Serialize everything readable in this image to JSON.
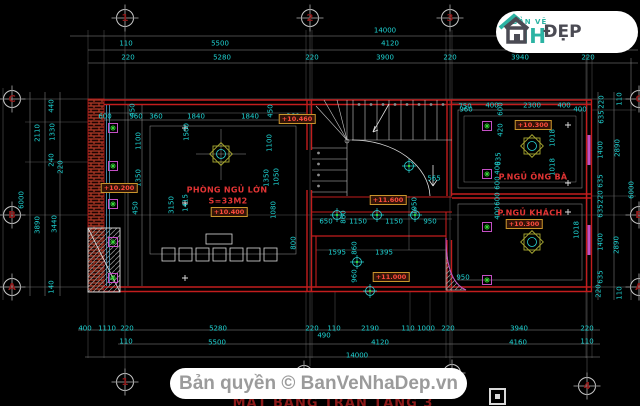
{
  "logo": {
    "tagline": "BẢN VẼ",
    "brand_left": "NH",
    "brand_right": "ĐẸP"
  },
  "footer": {
    "copyright": "Bản quyền © BanVeNhaDep.vn",
    "title": "MẶT BẰNG TRẦN TẦNG 3"
  },
  "colors": {
    "background": "#000000",
    "dimension_text": "#1ed3d3",
    "wall": "#c21d1d",
    "room_label": "#e23434",
    "brand_teal": "#2bb3a3",
    "brand_dark": "#4b4b54"
  },
  "grid": {
    "bubbles": [
      {
        "label": "1",
        "x": 125,
        "y": 18
      },
      {
        "label": "2",
        "x": 310,
        "y": 18
      },
      {
        "label": "3",
        "x": 450,
        "y": 18
      },
      {
        "label": "C",
        "x": 12,
        "y": 99
      },
      {
        "label": "B",
        "x": 12,
        "y": 215
      },
      {
        "label": "A",
        "x": 12,
        "y": 287
      },
      {
        "label": "1",
        "x": 125,
        "y": 382
      },
      {
        "label": "2",
        "x": 304,
        "y": 374
      },
      {
        "label": "3",
        "x": 452,
        "y": 373
      },
      {
        "label": "4",
        "x": 587,
        "y": 386
      },
      {
        "label": "C",
        "x": 639,
        "y": 99
      },
      {
        "label": "B",
        "x": 639,
        "y": 215
      },
      {
        "label": "A",
        "x": 639,
        "y": 287
      }
    ]
  },
  "labels": [
    {
      "t": "14000",
      "x": 385,
      "y": 31
    },
    {
      "t": "110",
      "x": 126,
      "y": 44
    },
    {
      "t": "5500",
      "x": 220,
      "y": 44
    },
    {
      "t": "4120",
      "x": 390,
      "y": 44
    },
    {
      "t": "220",
      "x": 128,
      "y": 58
    },
    {
      "t": "5280",
      "x": 222,
      "y": 58
    },
    {
      "t": "220",
      "x": 312,
      "y": 58
    },
    {
      "t": "3900",
      "x": 385,
      "y": 58
    },
    {
      "t": "220",
      "x": 450,
      "y": 58
    },
    {
      "t": "3940",
      "x": 520,
      "y": 58
    },
    {
      "t": "220",
      "x": 588,
      "y": 58
    },
    {
      "t": "400",
      "x": 85,
      "y": 329
    },
    {
      "t": "1110",
      "x": 107,
      "y": 329
    },
    {
      "t": "220",
      "x": 127,
      "y": 329
    },
    {
      "t": "5280",
      "x": 218,
      "y": 329
    },
    {
      "t": "220",
      "x": 312,
      "y": 329
    },
    {
      "t": "110",
      "x": 334,
      "y": 329
    },
    {
      "t": "2190",
      "x": 370,
      "y": 329
    },
    {
      "t": "110",
      "x": 408,
      "y": 329
    },
    {
      "t": "1000",
      "x": 426,
      "y": 329
    },
    {
      "t": "220",
      "x": 448,
      "y": 329
    },
    {
      "t": "3940",
      "x": 519,
      "y": 329
    },
    {
      "t": "220",
      "x": 587,
      "y": 329
    },
    {
      "t": "490",
      "x": 324,
      "y": 336
    },
    {
      "t": "110",
      "x": 126,
      "y": 342
    },
    {
      "t": "5500",
      "x": 217,
      "y": 343
    },
    {
      "t": "4120",
      "x": 380,
      "y": 343
    },
    {
      "t": "4160",
      "x": 518,
      "y": 343
    },
    {
      "t": "110",
      "x": 587,
      "y": 342
    },
    {
      "t": "14000",
      "x": 357,
      "y": 356
    },
    {
      "t": "6000",
      "x": 22,
      "y": 200,
      "r": 1
    },
    {
      "t": "2110",
      "x": 38,
      "y": 133,
      "r": 1
    },
    {
      "t": "3890",
      "x": 38,
      "y": 225,
      "r": 1
    },
    {
      "t": "440",
      "x": 52,
      "y": 106,
      "r": 1
    },
    {
      "t": "1330",
      "x": 53,
      "y": 132,
      "r": 1
    },
    {
      "t": "240",
      "x": 52,
      "y": 160,
      "r": 1
    },
    {
      "t": "220",
      "x": 61,
      "y": 167,
      "r": 1
    },
    {
      "t": "3440",
      "x": 55,
      "y": 224,
      "r": 1
    },
    {
      "t": "140",
      "x": 52,
      "y": 287,
      "r": 1
    },
    {
      "t": "220",
      "x": 602,
      "y": 102,
      "r": 1
    },
    {
      "t": "635",
      "x": 602,
      "y": 117,
      "r": 1
    },
    {
      "t": "1400",
      "x": 601,
      "y": 150,
      "r": 1
    },
    {
      "t": "635",
      "x": 601,
      "y": 181,
      "r": 1
    },
    {
      "t": "220",
      "x": 601,
      "y": 197,
      "r": 1
    },
    {
      "t": "635",
      "x": 601,
      "y": 211,
      "r": 1
    },
    {
      "t": "1400",
      "x": 601,
      "y": 242,
      "r": 1
    },
    {
      "t": "635",
      "x": 601,
      "y": 277,
      "r": 1
    },
    {
      "t": "220",
      "x": 599,
      "y": 291,
      "r": 1
    },
    {
      "t": "110",
      "x": 620,
      "y": 99,
      "r": 1
    },
    {
      "t": "2890",
      "x": 618,
      "y": 148,
      "r": 1
    },
    {
      "t": "2890",
      "x": 617,
      "y": 245,
      "r": 1
    },
    {
      "t": "110",
      "x": 620,
      "y": 293,
      "r": 1
    },
    {
      "t": "6000",
      "x": 632,
      "y": 190,
      "r": 1
    },
    {
      "t": "600",
      "x": 105,
      "y": 117
    },
    {
      "t": "960",
      "x": 136,
      "y": 117
    },
    {
      "t": "360",
      "x": 156,
      "y": 117
    },
    {
      "t": "1840",
      "x": 196,
      "y": 117
    },
    {
      "t": "1840",
      "x": 250,
      "y": 117
    },
    {
      "t": "360",
      "x": 293,
      "y": 117
    },
    {
      "t": "450",
      "x": 133,
      "y": 110,
      "r": 1
    },
    {
      "t": "450",
      "x": 271,
      "y": 111,
      "r": 1
    },
    {
      "t": "1100",
      "x": 139,
      "y": 141,
      "r": 1
    },
    {
      "t": "1500",
      "x": 187,
      "y": 132,
      "r": 1
    },
    {
      "t": "1100",
      "x": 270,
      "y": 143,
      "r": 1
    },
    {
      "t": "1350",
      "x": 139,
      "y": 178,
      "r": 1
    },
    {
      "t": "1350",
      "x": 267,
      "y": 178,
      "r": 1
    },
    {
      "t": "1050",
      "x": 277,
      "y": 177,
      "r": 1
    },
    {
      "t": "1080",
      "x": 274,
      "y": 210,
      "r": 1
    },
    {
      "t": "450",
      "x": 136,
      "y": 208,
      "r": 1
    },
    {
      "t": "1415",
      "x": 186,
      "y": 203,
      "r": 1
    },
    {
      "t": "3150",
      "x": 172,
      "y": 205,
      "r": 1
    },
    {
      "t": "960",
      "x": 466,
      "y": 110
    },
    {
      "t": "565",
      "x": 434,
      "y": 179
    },
    {
      "t": "650",
      "x": 326,
      "y": 222
    },
    {
      "t": "1150",
      "x": 358,
      "y": 222
    },
    {
      "t": "1150",
      "x": 394,
      "y": 222
    },
    {
      "t": "950",
      "x": 430,
      "y": 222
    },
    {
      "t": "1595",
      "x": 337,
      "y": 253
    },
    {
      "t": "1395",
      "x": 384,
      "y": 253
    },
    {
      "t": "950",
      "x": 463,
      "y": 278
    },
    {
      "t": "1950",
      "x": 415,
      "y": 206,
      "r": 1
    },
    {
      "t": "860",
      "x": 344,
      "y": 217,
      "r": 1
    },
    {
      "t": "860",
      "x": 355,
      "y": 248,
      "r": 1
    },
    {
      "t": "960",
      "x": 355,
      "y": 276,
      "r": 1
    },
    {
      "t": "800",
      "x": 294,
      "y": 243,
      "r": 1
    },
    {
      "t": "750",
      "x": 465,
      "y": 107
    },
    {
      "t": "400",
      "x": 492,
      "y": 106
    },
    {
      "t": "2300",
      "x": 532,
      "y": 106
    },
    {
      "t": "400",
      "x": 564,
      "y": 106
    },
    {
      "t": "400",
      "x": 580,
      "y": 110
    },
    {
      "t": "600",
      "x": 501,
      "y": 109,
      "r": 1
    },
    {
      "t": "420",
      "x": 501,
      "y": 130,
      "r": 1
    },
    {
      "t": "635",
      "x": 499,
      "y": 159,
      "r": 1
    },
    {
      "t": "1018",
      "x": 553,
      "y": 138,
      "r": 1
    },
    {
      "t": "1018",
      "x": 553,
      "y": 167,
      "r": 1
    },
    {
      "t": "400",
      "x": 498,
      "y": 168,
      "r": 1
    },
    {
      "t": "600",
      "x": 498,
      "y": 183,
      "r": 1
    },
    {
      "t": "600",
      "x": 498,
      "y": 199,
      "r": 1
    },
    {
      "t": "400",
      "x": 498,
      "y": 213,
      "r": 1
    },
    {
      "t": "1018",
      "x": 577,
      "y": 230,
      "r": 1
    },
    {
      "t": "PHÒNG NGỦ LỚN",
      "x": 227,
      "y": 190,
      "k": "room"
    },
    {
      "t": "S=33M2",
      "x": 228,
      "y": 201,
      "k": "room"
    },
    {
      "t": "P.NGỦ ÔNG BÀ",
      "x": 533,
      "y": 177,
      "k": "room"
    },
    {
      "t": "P.NGỦ KHÁCH",
      "x": 530,
      "y": 213,
      "k": "room"
    },
    {
      "t": "+10.400",
      "x": 229,
      "y": 212,
      "k": "lvl"
    },
    {
      "t": "+10.200",
      "x": 119,
      "y": 188,
      "k": "lvl"
    },
    {
      "t": "+10.460",
      "x": 297,
      "y": 119,
      "k": "lvl"
    },
    {
      "t": "+11.600",
      "x": 388,
      "y": 200,
      "k": "lvl"
    },
    {
      "t": "+11.000",
      "x": 391,
      "y": 277,
      "k": "lvl"
    },
    {
      "t": "+10.300",
      "x": 533,
      "y": 125,
      "k": "lvl"
    },
    {
      "t": "+10.300",
      "x": 524,
      "y": 224,
      "k": "lvl"
    }
  ]
}
